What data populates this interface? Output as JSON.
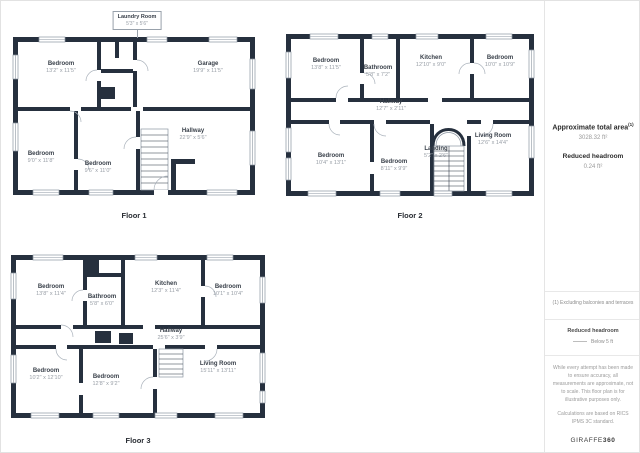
{
  "floors": [
    {
      "label": "Floor 1",
      "callout": {
        "name": "Laundry Room",
        "dims": "5'3\" x 5'6\""
      },
      "rooms": [
        {
          "name": "Bedroom",
          "dims": "13'2\" x 11'5\""
        },
        {
          "name": "Garage",
          "dims": "19'9\" x 11'5\""
        },
        {
          "name": "Bedroom",
          "dims": "9'0\" x 11'8\""
        },
        {
          "name": "Bedroom",
          "dims": "9'6\" x 11'0\""
        },
        {
          "name": "Hallway",
          "dims": "22'9\" x 5'6\""
        }
      ]
    },
    {
      "label": "Floor 2",
      "rooms": [
        {
          "name": "Bedroom",
          "dims": "13'8\" x 11'5\""
        },
        {
          "name": "Bathroom",
          "dims": "5'8\" x 7'2\""
        },
        {
          "name": "Kitchen",
          "dims": "12'10\" x 9'0\""
        },
        {
          "name": "Bedroom",
          "dims": "10'0\" x 10'9\""
        },
        {
          "name": "Hallway",
          "dims": "12'7\" x 2'11\""
        },
        {
          "name": "Bedroom",
          "dims": "10'4\" x 13'1\""
        },
        {
          "name": "Bedroom",
          "dims": "8'11\" x 9'9\""
        },
        {
          "name": "Landing",
          "dims": "5'2\" x 2'6\""
        },
        {
          "name": "Living Room",
          "dims": "12'6\" x 14'4\""
        }
      ]
    },
    {
      "label": "Floor 3",
      "rooms": [
        {
          "name": "Bedroom",
          "dims": "13'8\" x 11'4\""
        },
        {
          "name": "Bathroom",
          "dims": "5'8\" x 6'0\""
        },
        {
          "name": "Kitchen",
          "dims": "12'3\" x 11'4\""
        },
        {
          "name": "Bedroom",
          "dims": "10'1\" x 10'4\""
        },
        {
          "name": "Hallway",
          "dims": "25'6\" x 3'9\""
        },
        {
          "name": "Bedroom",
          "dims": "10'2\" x 12'10\""
        },
        {
          "name": "Bedroom",
          "dims": "12'8\" x 9'2\""
        },
        {
          "name": "Living Room",
          "dims": "15'11\" x 13'11\""
        }
      ]
    }
  ],
  "sidebar": {
    "total_area_label": "Approximate total area",
    "total_area_superscript": "(1)",
    "total_area_value": "3028.32 ft²",
    "reduced_headroom_label": "Reduced headroom",
    "reduced_headroom_value": "0.24 ft²",
    "footnote": "(1) Excluding balconies and terraces",
    "legend_title": "Reduced headroom",
    "legend_item": "Below 5 ft",
    "disclaimer_1": "While every attempt has been made to ensure accuracy, all measurements are approximate, not to scale. This floor plan is for illustrative purposes only.",
    "disclaimer_2": "Calculations are based on RICS IPMS 3C standard.",
    "brand": "GIRAFFE",
    "brand_suffix": "360"
  },
  "colors": {
    "wall": "#26303e",
    "accent_gray": "#9aa0a6"
  }
}
